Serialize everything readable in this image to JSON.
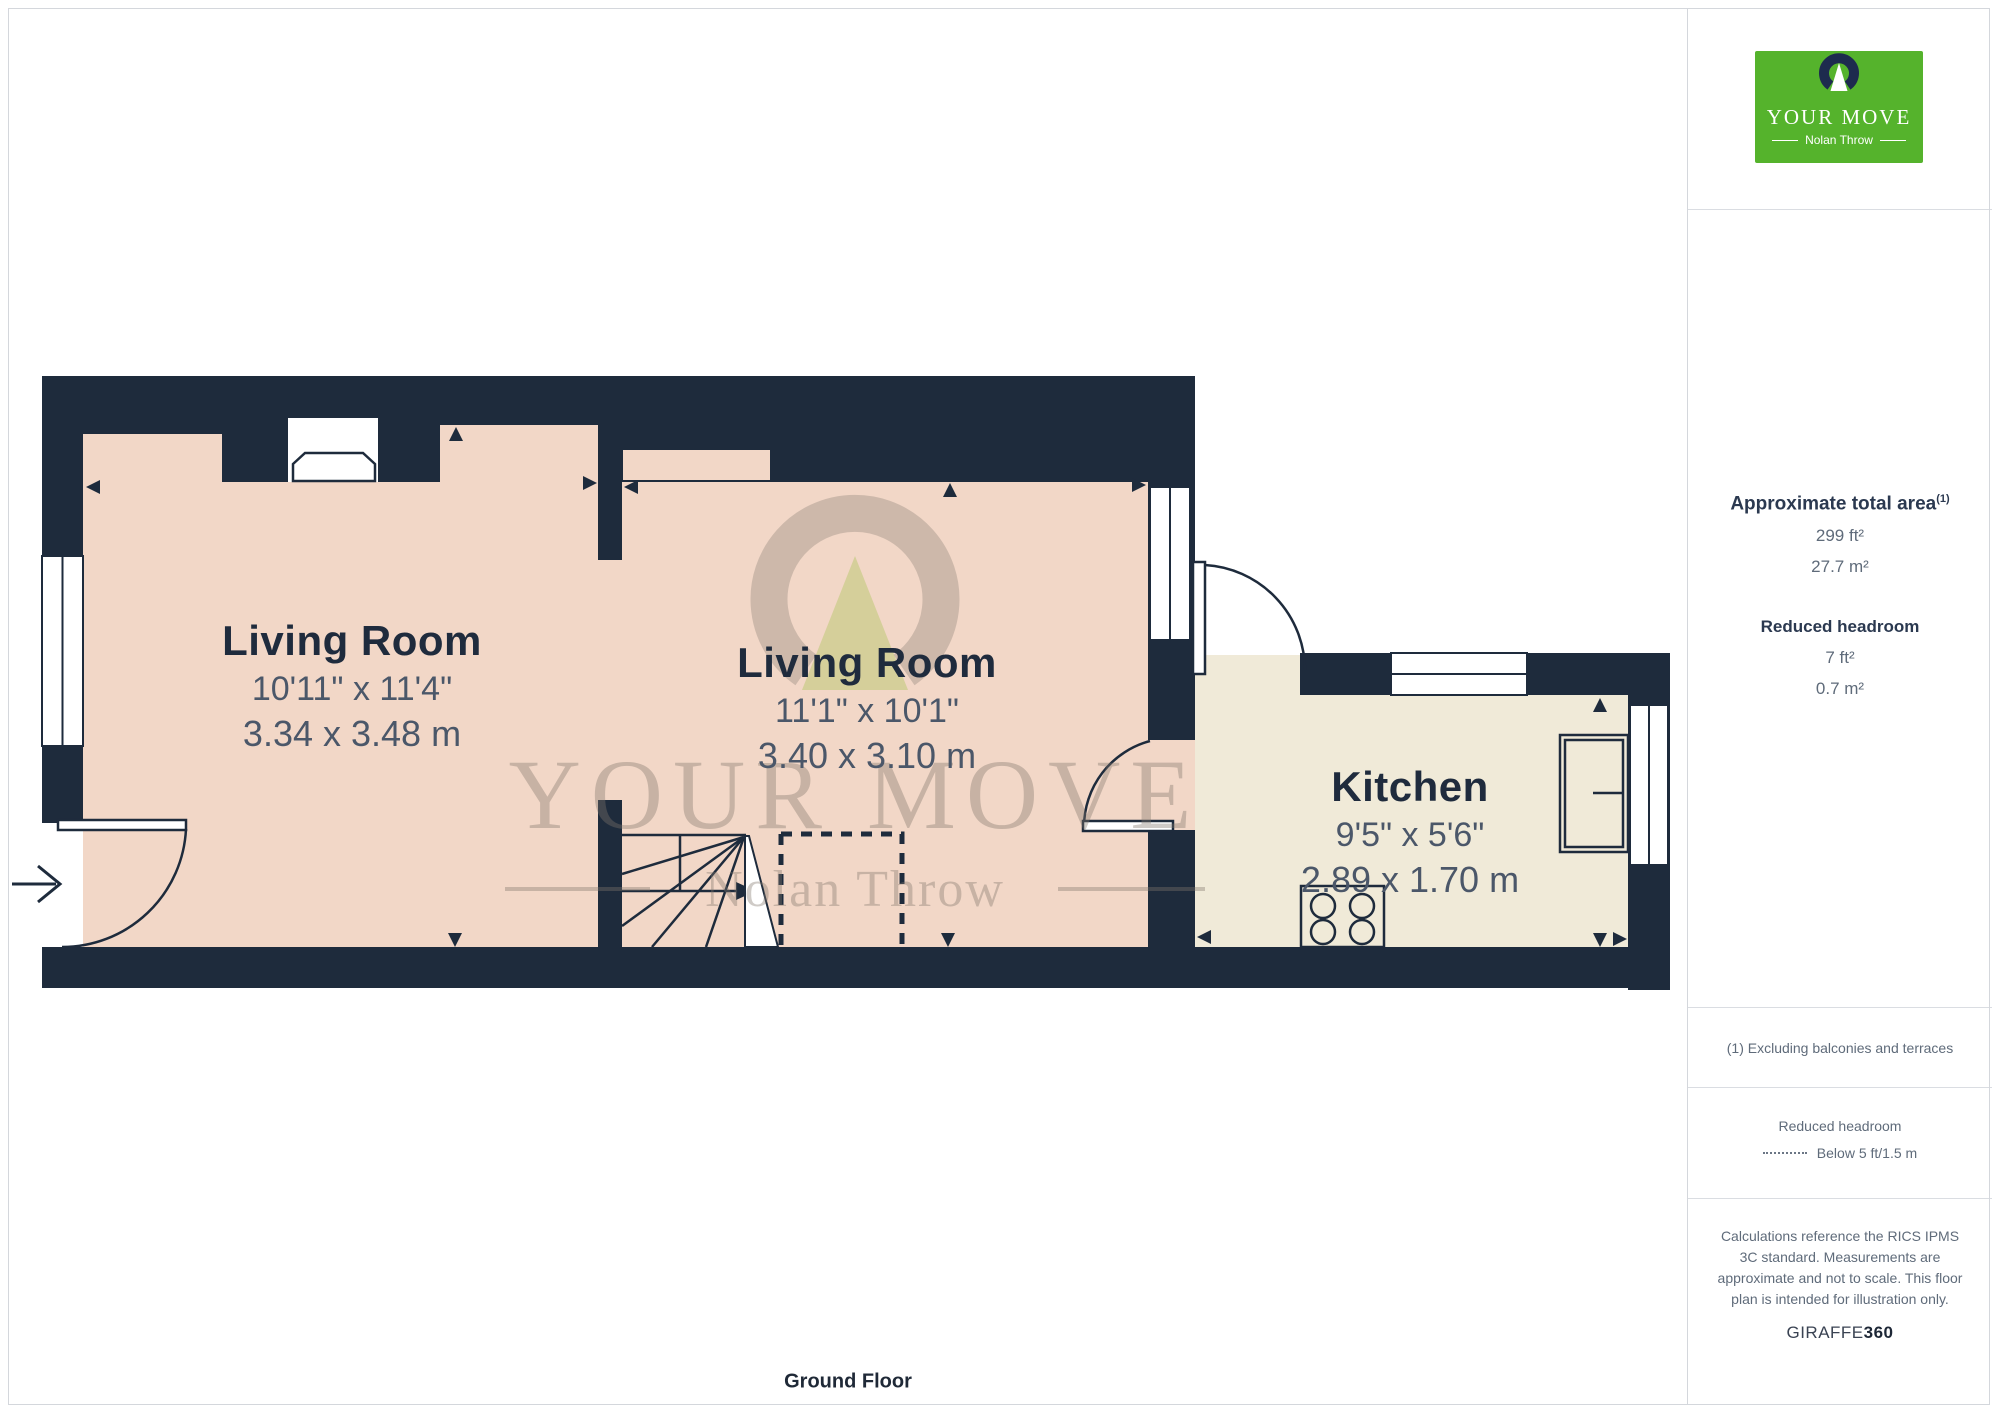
{
  "footer": {
    "label": "Ground Floor"
  },
  "rooms": [
    {
      "name": "Living Room",
      "imperial": "10'11\" x 11'4\"",
      "metric": "3.34 x 3.48 m"
    },
    {
      "name": "Living Room",
      "imperial": "11'1\" x 10'1\"",
      "metric": "3.40 x 3.10 m"
    },
    {
      "name": "Kitchen",
      "imperial": "9'5\" x 5'6\"",
      "metric": "2.89 x 1.70 m"
    }
  ],
  "watermark": {
    "line1": "YOUR MOVE",
    "line2": "Nolan Throw"
  },
  "sidebar": {
    "logo": {
      "brand": "YOUR MOVE",
      "sub": "Nolan Throw"
    },
    "area": {
      "title": "Approximate total area",
      "superscript": "(1)",
      "value_ft": "299 ft²",
      "value_m": "27.7 m²",
      "reduced_title": "Reduced headroom",
      "reduced_ft": "7 ft²",
      "reduced_m": "0.7 m²"
    },
    "footnote": "(1) Excluding balconies and terraces",
    "legend": {
      "title": "Reduced headroom",
      "item": "Below 5 ft/1.5 m"
    },
    "disclaimer": "Calculations reference the RICS IPMS 3C standard. Measurements are approximate and not to scale. This floor plan is intended for illustration only.",
    "brand_footer": {
      "name": "GIRAFFE",
      "suffix": "360"
    }
  },
  "colors": {
    "wall": "#1e2b3c",
    "floor_pink": "#f2d7c7",
    "floor_cream": "#f0ead8",
    "brand_green": "#55b32c",
    "brand_navy": "#1d2b4e",
    "text_dark": "#1f2b3d",
    "text_slate": "#4b5769"
  }
}
